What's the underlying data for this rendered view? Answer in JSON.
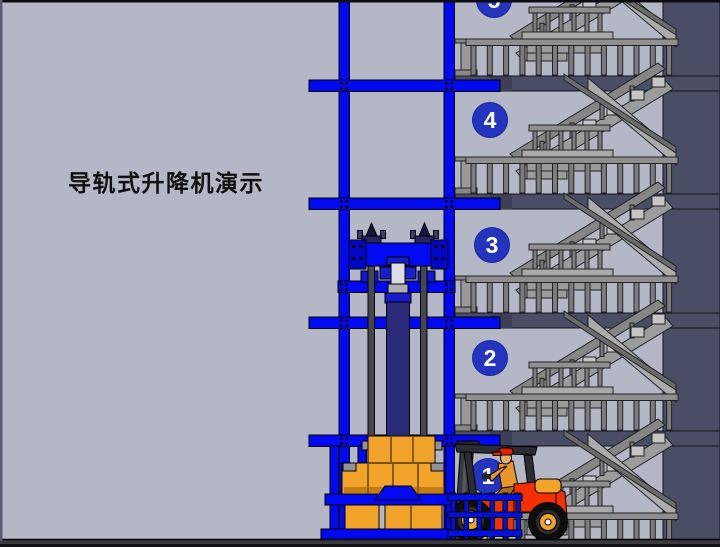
{
  "title": {
    "text": "导轨式升降机演示"
  },
  "floors": [
    {
      "label": "5"
    },
    {
      "label": "4"
    },
    {
      "label": "3"
    },
    {
      "label": "2"
    },
    {
      "label": "1"
    }
  ],
  "scene": {
    "elements": [
      "guide-rail-mast",
      "hydraulic-cylinder",
      "lift-carriage",
      "lift-platform",
      "cargo-boxes",
      "staircase",
      "floor-slabs",
      "forklift",
      "forklift-driver",
      "safety-cage",
      "ground"
    ]
  },
  "colors": {
    "background": "#b4b7c6",
    "wall_dark": "#4a4d66",
    "rail_blue": "#0009f0",
    "badge_blue": "#2434bf",
    "cylinder_navy": "#2a2a78",
    "stair_gray": "#9a9a9a",
    "cargo_yellow": "#f2a42a",
    "forklift_red": "#f23000",
    "ground_dark": "#3b3b3f",
    "title_color": "#101010"
  }
}
